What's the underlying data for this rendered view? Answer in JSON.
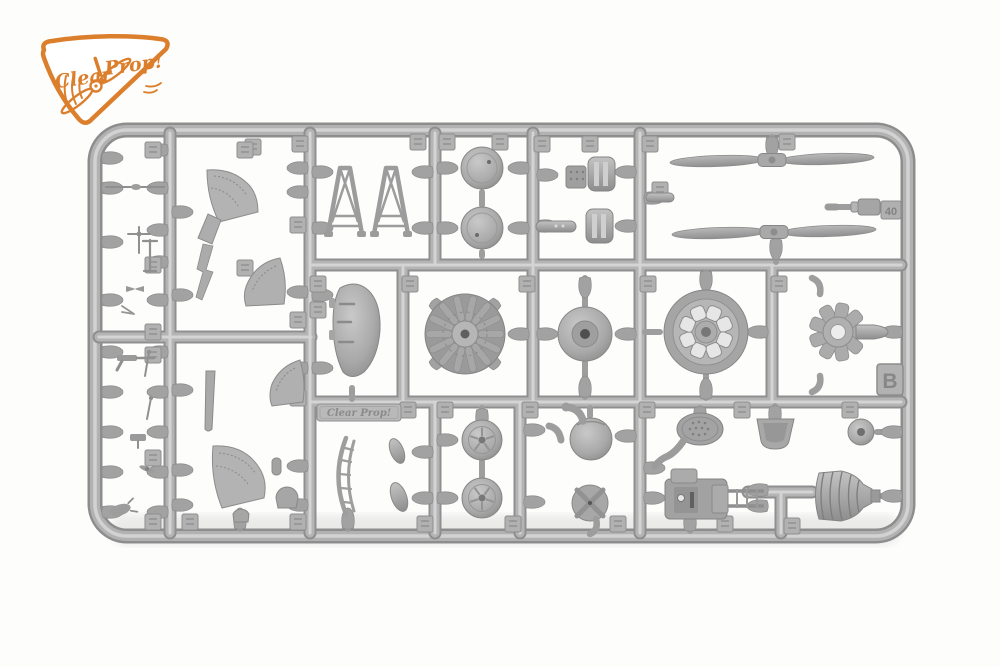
{
  "scene": {
    "type": "product-photo",
    "subject": "injection-molded plastic model kit sprue (runner frame) with aircraft parts, photographed on white",
    "background_color": "#fdfdfc"
  },
  "logo": {
    "word1": "Clear",
    "word2": "Prop!",
    "color": "#dc7f2d"
  },
  "sprue": {
    "plastic_color": "#adadad",
    "frame_letter": "B",
    "legible_part_number": "40",
    "embossed_brand": "Clear Prop!",
    "parts": [
      {
        "name": "two-blade propeller",
        "count": 2
      },
      {
        "name": "radial engine",
        "count": 1
      },
      {
        "name": "hub disc",
        "count": 1
      },
      {
        "name": "spoked main wheel",
        "count": 1
      },
      {
        "name": "cooling fan",
        "count": 1
      },
      {
        "name": "wheel disc",
        "count": 4
      },
      {
        "name": "cabane strut",
        "count": 2
      },
      {
        "name": "cowling panel",
        "count": 1
      },
      {
        "name": "fuselage deck segment",
        "count": 4
      },
      {
        "name": "honeycomb radiator",
        "count": 1
      },
      {
        "name": "engine accessory block",
        "count": 1
      },
      {
        "name": "bucket seat",
        "count": 1
      },
      {
        "name": "ribbed spinner cone",
        "count": 1
      },
      {
        "name": "ribbed box",
        "count": 2
      },
      {
        "name": "tail wheel",
        "count": 1
      },
      {
        "name": "ball tank",
        "count": 1
      },
      {
        "name": "small detail parts",
        "count": 20
      }
    ]
  }
}
